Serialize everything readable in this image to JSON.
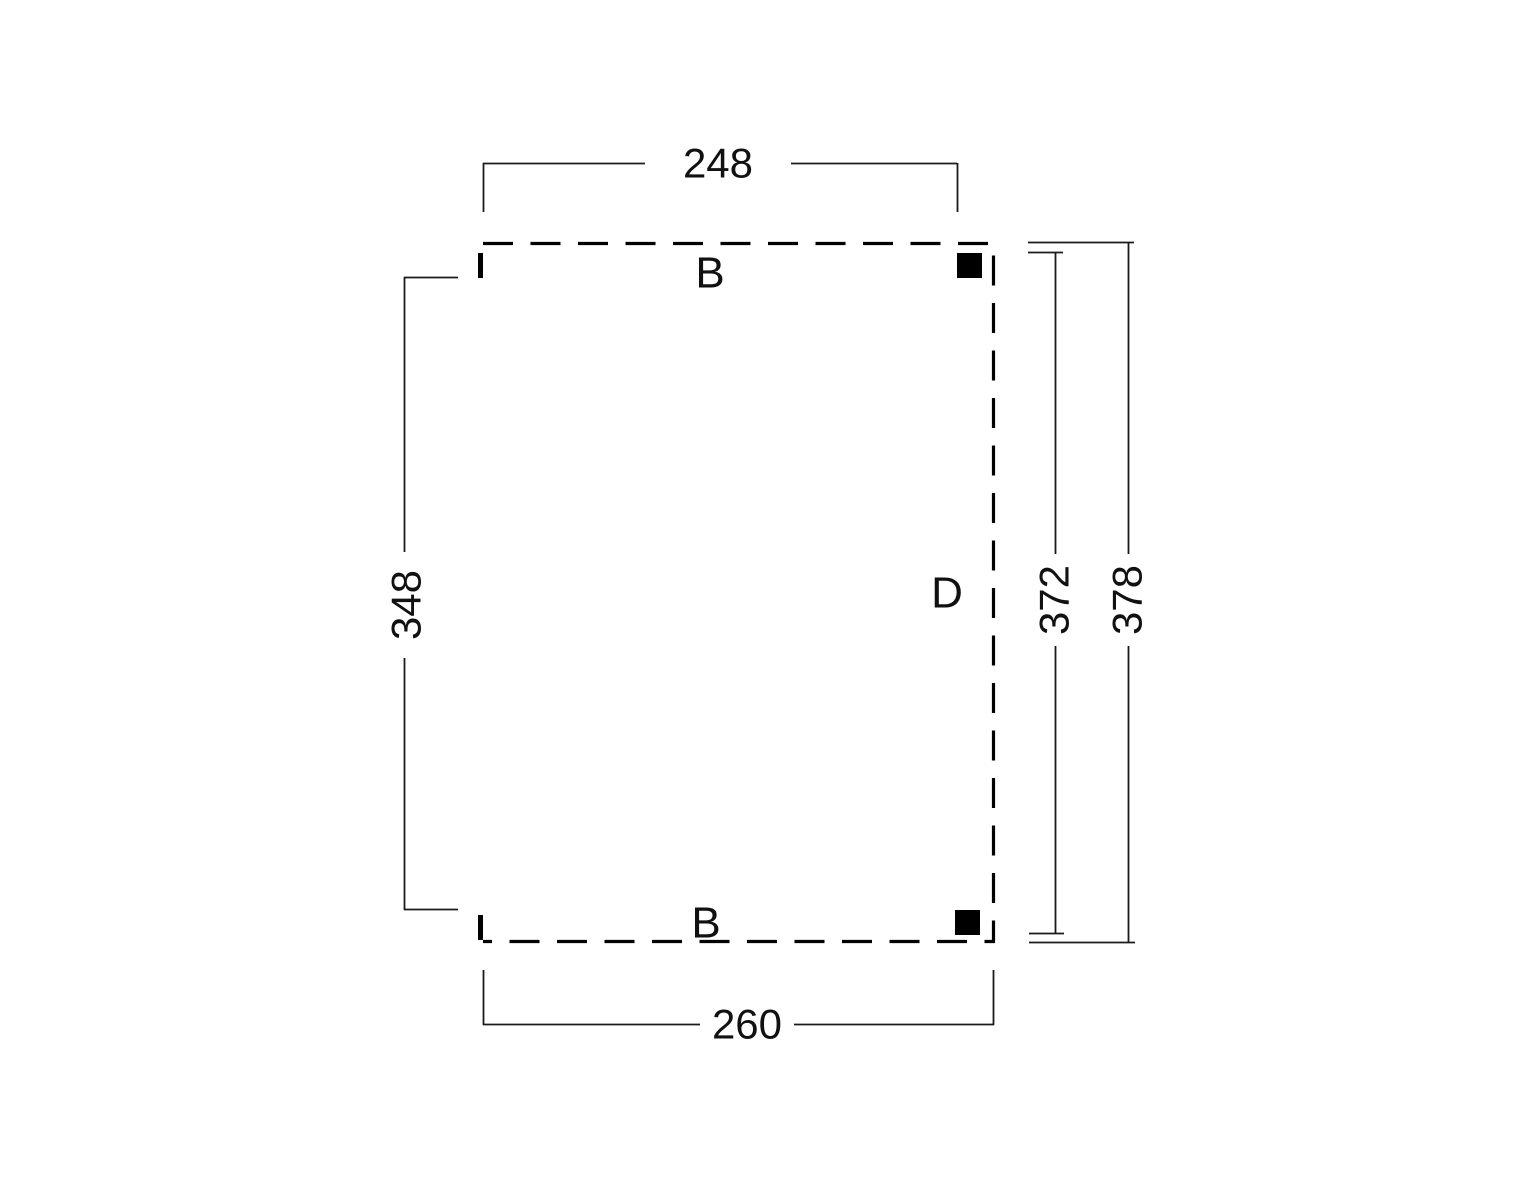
{
  "diagram": {
    "kind": "floor-plan dimension drawing",
    "background_color": "#ffffff",
    "line_color": "#000000",
    "dimensions": {
      "top": "248",
      "bottom": "260",
      "left": "348",
      "right_inner": "372",
      "right_outer": "378"
    },
    "labels": {
      "top_edge": "B",
      "bottom_edge": "B",
      "right_edge": "D"
    },
    "markers": {
      "post_top_right": "filled-square",
      "post_bottom_right": "filled-square",
      "tick_top_left": "thick-tick",
      "tick_bottom_left": "thick-tick"
    }
  }
}
